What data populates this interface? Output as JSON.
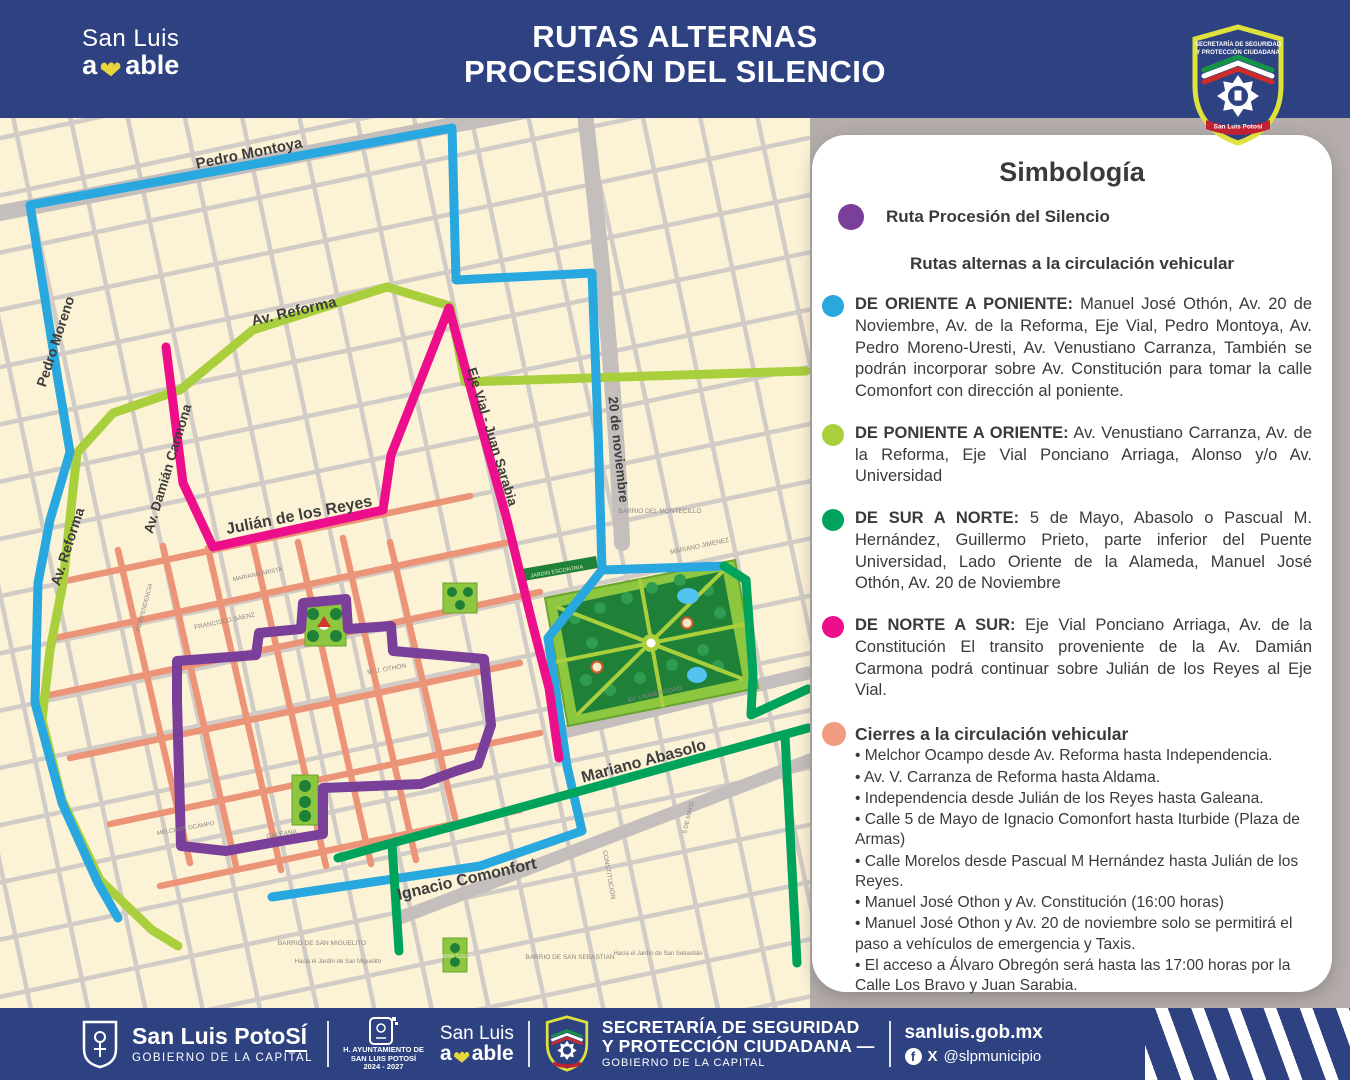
{
  "header": {
    "logo": {
      "line1": "San Luis",
      "amable_prefix": "a",
      "amable_suffix": "able"
    },
    "title_line1": "RUTAS ALTERNAS",
    "title_line2": "PROCESIÓN DEL SILENCIO",
    "badge": {
      "line1": "SECRETARÍA DE SEGURIDAD",
      "line2": "Y PROTECCIÓN CIUDADANA",
      "banner": "San Luis Potosí"
    }
  },
  "map": {
    "route_colors": {
      "blue": "#29a8e0",
      "light_green": "#a9cf3d",
      "dark_green": "#00a35b",
      "pink": "#ec0e8a",
      "purple": "#7a3f98",
      "closures": "#eb9478"
    },
    "streets": {
      "pedro_montoya": "Pedro Montoya",
      "pedro_moreno": "Pedro Moreno",
      "av_reforma_vertical": "Av. Reforma",
      "av_reforma_diagonal": "Av. Reforma",
      "av_damian_carmona": "Av. Damián Carmona",
      "julian_de_los_reyes": "Julián de los Reyes",
      "eje_vial_juan_sarabia": "Eje Vial - Juan Sarabia",
      "veinte_de_noviembre": "20 de noviembre",
      "mariano_abasolo": "Mariano Abasolo",
      "ignacio_comonfort": "Ignacio Comonfort"
    },
    "minor": {
      "barrio_montecillo": "BARRIO DEL MONTECILLO",
      "mariano_jimenez": "MARIANO JIMENEZ",
      "jardin_escontria": "JARDIN ESCONTRIA",
      "galeana": "GALEANA",
      "melchor_ocampo": "MELCHOR OCAMPO",
      "m_j_othon": "M. J. OTHON",
      "av_universidad": "AV. UNIVERSIDAD",
      "independencia": "INDEPENDENCIA",
      "francisco_saenz": "FRANCISCO SAENZ",
      "mariano_arista": "MARIANO ARISTA",
      "constitucion": "CONSTITUCION",
      "cinco_de_mayo": "5 DE MAYO",
      "barrio_san_miguelito": "BARRIO DE SAN MIGUELITO",
      "hacia_san_miguelito": "Hacia el Jardín de San Miguelito",
      "barrio_san_sebastian": "BARRIO DE SAN SEBASTIAN",
      "hacia_san_sebastian": "Hacia el Jardín de San Sebastián",
      "jardin_colon": "JARDIN COLON"
    }
  },
  "legend": {
    "title": "Simbología",
    "procession": {
      "color": "#7a3f98",
      "label": "Ruta Procesión del Silencio"
    },
    "subtitle": "Rutas alternas a la circulación vehicular",
    "routes": [
      {
        "color": "#29a8e0",
        "name": "DE ORIENTE A PONIENTE:",
        "description": " Manuel José Othón, Av. 20 de Noviembre, Av. de la Reforma, Eje Vial, Pedro Montoya, Av. Pedro Moreno-Uresti,  Av. Venustiano Carranza, También se podrán incorporar sobre Av. Constitución para tomar la calle Comonfort con dirección al poniente."
      },
      {
        "color": "#a9cf3d",
        "name": "DE PONIENTE A ORIENTE:",
        "description": " Av. Venustiano Carranza, Av. de la Reforma, Eje Vial Ponciano Arriaga,  Alonso y/o Av. Universidad"
      },
      {
        "color": "#00a35b",
        "name": "DE SUR A NORTE:",
        "description": " 5 de Mayo, Abasolo o Pascual M. Hernández, Guillermo Prieto, parte inferior del Puente Universidad, Lado Oriente de la Alameda, Manuel José Othón, Av. 20 de Noviembre"
      },
      {
        "color": "#ec0e8a",
        "name": "DE NORTE A SUR:",
        "description": " Eje Vial Ponciano Arriaga, Av. de la Constitución  El transito proveniente de la Av. Damián Carmona podrá continuar sobre Julián de los Reyes al Eje Vial."
      }
    ],
    "closures": {
      "color": "#f09c80",
      "title": "Cierres a la circulación vehicular",
      "items": [
        "Melchor Ocampo desde Av. Reforma hasta Independencia.",
        "Av. V. Carranza de Reforma hasta Aldama.",
        "Independencia desde Julián de los Reyes hasta Galeana.",
        "Calle 5 de Mayo de Ignacio Comonfort hasta Iturbide (Plaza de Armas)",
        "Calle Morelos desde Pascual M Hernández hasta Julián de los Reyes.",
        "Manuel José Othon y Av. Constitución (16:00 horas)",
        "Manuel José Othon y Av. 20 de noviembre  solo se permitirá el paso a vehículos de emergencia y Taxis.",
        "El acceso a Álvaro Obregón será hasta las 17:00 horas por la Calle Los Bravo y Juan Sarabia."
      ]
    }
  },
  "footer": {
    "slp": {
      "name_prefix": "San Luis Poto",
      "name_suffix": "SÍ",
      "caption": "GOBIERNO DE LA CAPITAL"
    },
    "ayuntamiento": {
      "line1": "H. AYUNTAMIENTO DE",
      "line2": "SAN LUIS POTOSÍ",
      "line3": "2024 - 2027"
    },
    "amable": {
      "line1": "San Luis",
      "prefix": "a",
      "suffix": "able"
    },
    "secretaria": {
      "line1": "SECRETARÍA DE SEGURIDAD",
      "line2": "Y PROTECCIÓN CIUDADANA —",
      "caption": "GOBIERNO DE LA CAPITAL"
    },
    "web": "sanluis.gob.mx",
    "social": "@slpmunicipio"
  }
}
